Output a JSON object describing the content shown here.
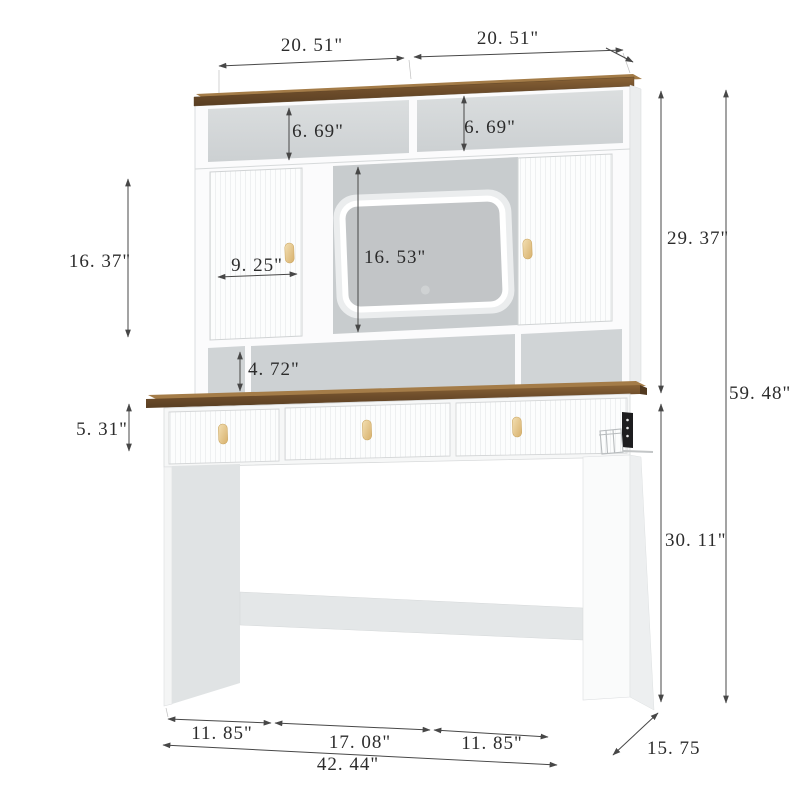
{
  "diagram": {
    "unit": "inch",
    "dims": {
      "hutch_top_left_width": "20. 51\"",
      "hutch_top_right_width": "20. 51\"",
      "upper_shelf_left_height": "6. 69\"",
      "upper_shelf_right_height": "6. 69\"",
      "cabinet_height": "16. 37\"",
      "cabinet_door_width": "9. 25\"",
      "mirror_section_height": "16. 53\"",
      "hutch_height": "29. 37\"",
      "total_height": "59. 48\"",
      "open_shelf_height": "4. 72\"",
      "drawer_height": "5. 31\"",
      "desk_height": "30. 11\"",
      "floor_left_width": "11. 85\"",
      "floor_center_width": "17. 08\"",
      "floor_right_width": "11. 85\"",
      "total_width": "42. 44\"",
      "depth": "15. 75"
    },
    "colors": {
      "wood_top": "#7a5836",
      "handle_gold": "#e6c98f",
      "panel_gray": "#c9cdcf",
      "led_ring": "#ffffff",
      "dimension_line": "#474747",
      "power_strip": "#1d1d1f"
    }
  }
}
